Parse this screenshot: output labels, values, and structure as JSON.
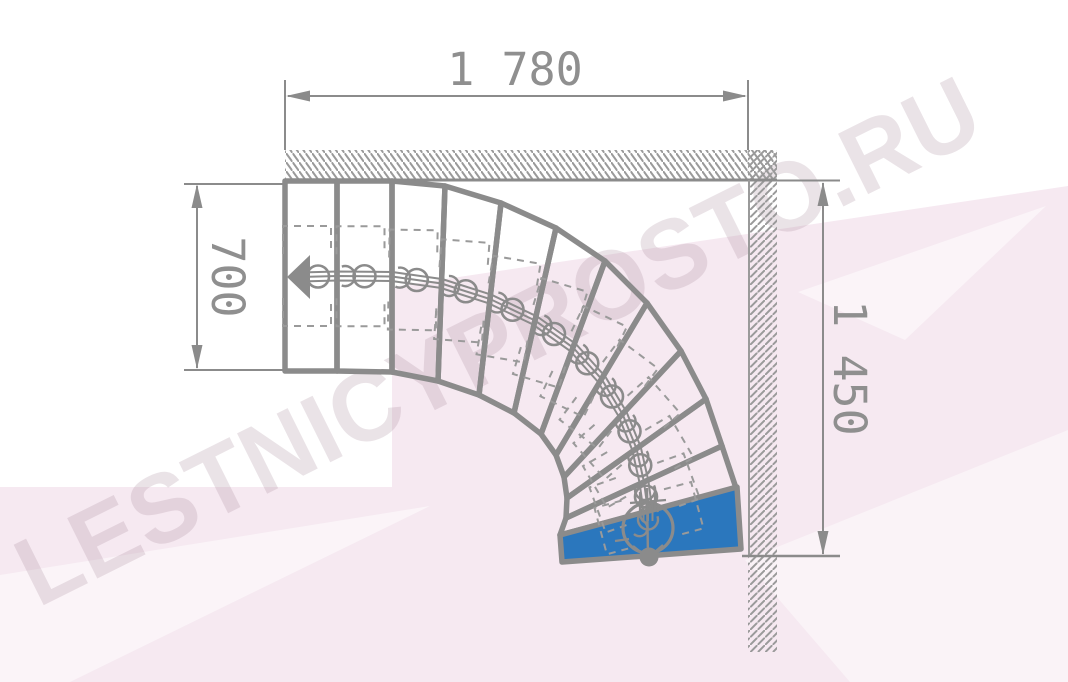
{
  "drawing": {
    "type_label": "winder-staircase-plan-90deg",
    "dimensions": {
      "top_width": "1 780",
      "left_entry_width": "700",
      "right_height": "1 450"
    },
    "watermark": "LESTNICYPROSTO.RU",
    "steps_total": 12,
    "first_step": {
      "index": 1,
      "highlight_color": "#2b77bd"
    },
    "colors": {
      "line_gray": "#8b8b8b",
      "hatch_gray": "#9a9a9a",
      "dim_text_gray": "#8f8f8f",
      "background_tint_pink": "#f6e9f1",
      "step_highlight_blue": "#2b77bd"
    }
  }
}
